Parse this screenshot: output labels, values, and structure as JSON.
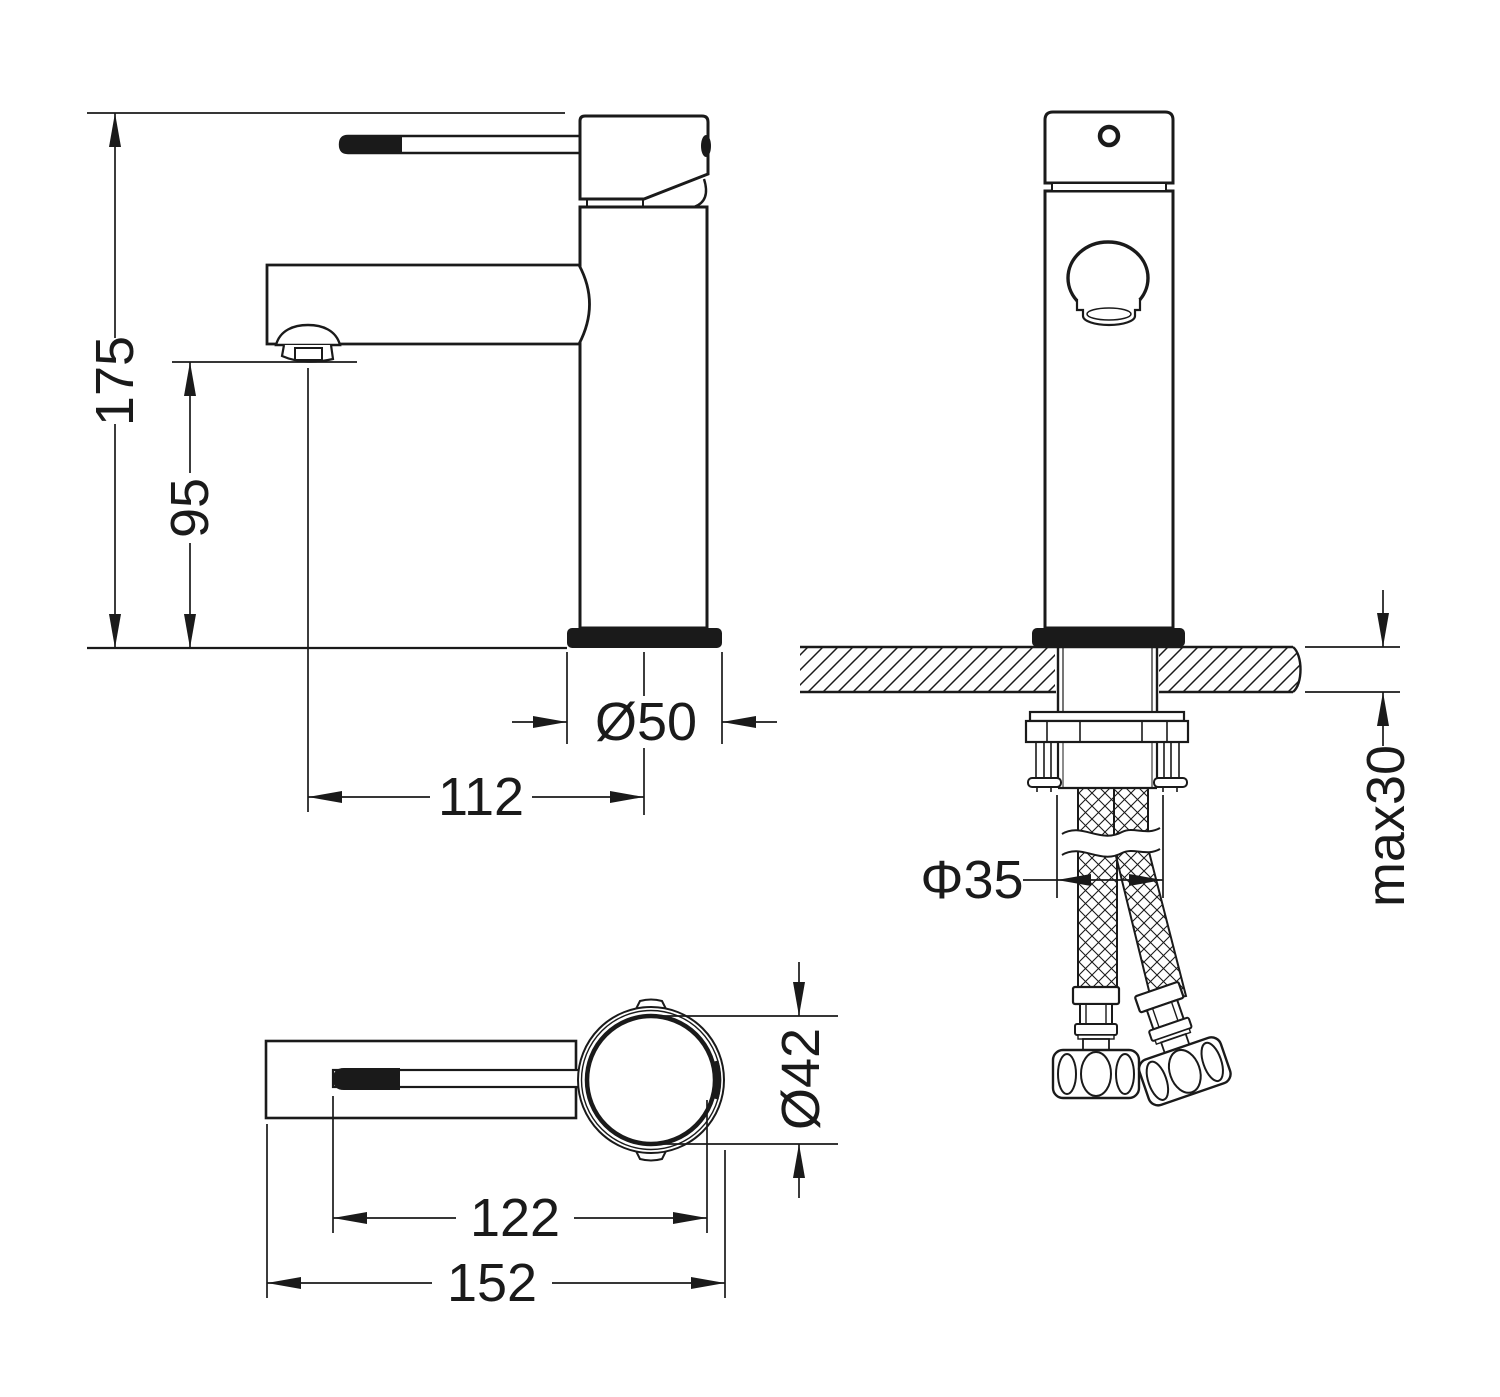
{
  "colors": {
    "line": "#1a1a1a",
    "background": "#ffffff"
  },
  "dimensions": {
    "total_height": "175",
    "outlet_height": "95",
    "base_diameter": "Ø50",
    "spout_reach": "112",
    "hole_diameter": "Φ35",
    "max_counter_thickness": "max30",
    "body_diameter": "Ø42",
    "lever_reach": "122",
    "overall_length": "152"
  }
}
